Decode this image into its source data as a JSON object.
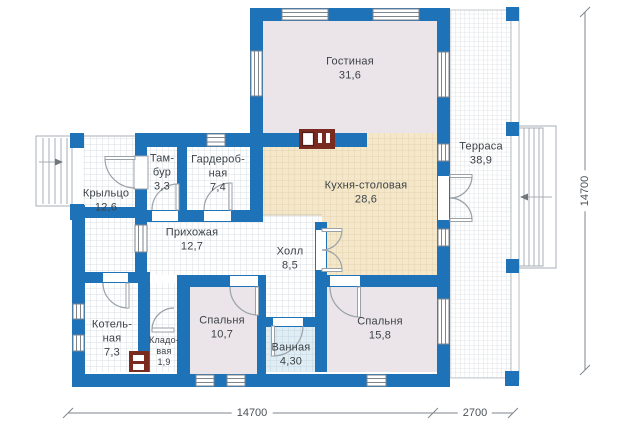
{
  "rooms": {
    "living": {
      "label": "Гостиная\n31,6"
    },
    "terrace": {
      "label": "Терраса\n38,9"
    },
    "kitchen": {
      "label": "Кухня-столовая\n28,6"
    },
    "tambour": {
      "label": "Там-\nбур\n3,3"
    },
    "wardrobe": {
      "label": "Гардероб-\nная\n7,4"
    },
    "porch": {
      "label": "Крыльцо\n12,6"
    },
    "hallway": {
      "label": "Прихожая\n12,7"
    },
    "hall": {
      "label": "Холл\n8,5"
    },
    "boiler": {
      "label": "Котель-\nная\n7,3"
    },
    "storage": {
      "label": "Кладо-\nвая\n1,9"
    },
    "bedroom1": {
      "label": "Спальня\n10,7"
    },
    "bathroom": {
      "label": "Ванная\n4,30"
    },
    "bedroom2": {
      "label": "Спальня\n15,8"
    }
  },
  "dimensions": {
    "width_main": "14700",
    "width_ext": "2700",
    "height": "14700"
  },
  "colors": {
    "wall": "#1e72b8",
    "floor_plain": "#ebe4e8",
    "floor_kitchen": "#f5e8ca",
    "floor_bath": "#e0edf3",
    "fireplace": "#7a2b1f",
    "line": "#8f979d",
    "text": "#3c4247"
  }
}
